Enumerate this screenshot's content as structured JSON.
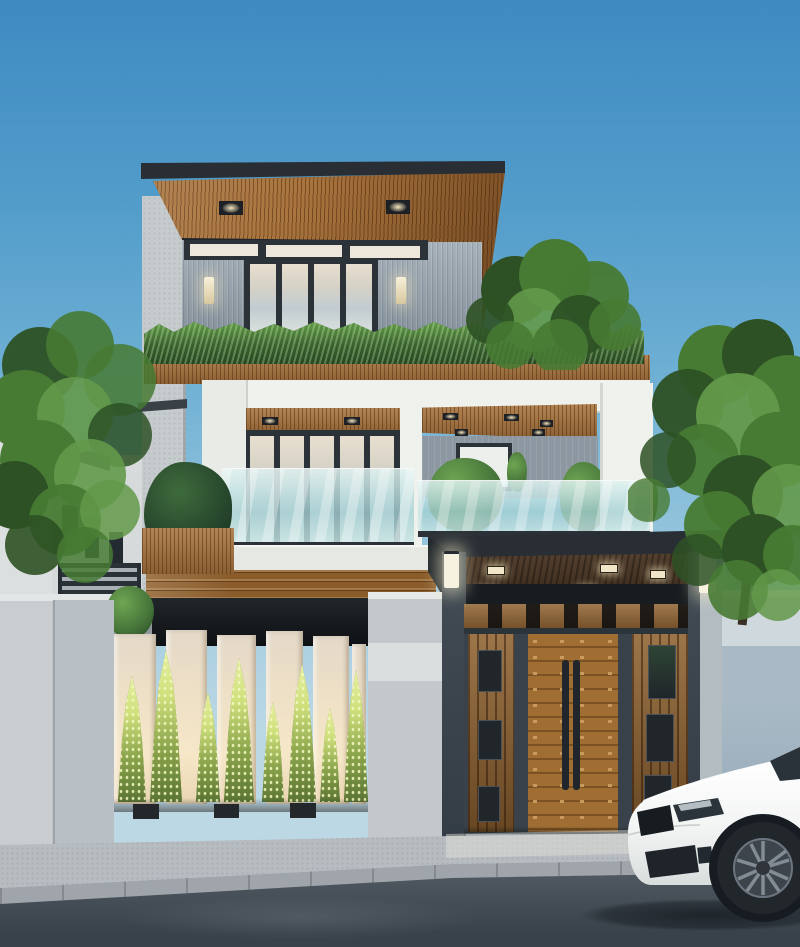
{
  "scene": {
    "type": "photorealistic architectural render",
    "subject": "modern three-story house at dusk with wood-slat roof soffits, glass balconies, backlit slatted fence with conical plants, wooden entry gate and a white sedan parked at the curb",
    "time_of_day": "dusk",
    "objects": [
      "sky",
      "cantilevered roof with wood soffit",
      "recessed ceiling lights",
      "gray vertical siding",
      "transom windows",
      "folding glass doors",
      "wall sconces",
      "balcony hedge",
      "white concrete balcony frame",
      "aqua glass balustrades",
      "terrace window",
      "potted plants",
      "carport canopy",
      "garage opening",
      "slatted fence with backlit cypress plants",
      "wooden double gate with steel frame",
      "gate lamps",
      "concrete boundary walls",
      "neighbor house with dark railing",
      "green trees",
      "sidewalk",
      "curbstones",
      "asphalt road",
      "white sedan with alloy wheel"
    ]
  },
  "palette": {
    "sky_top": "#3e8ac1",
    "sky_mid": "#6fb0d4",
    "sky_low": "#a9cfe0",
    "roof_fascia": "#282e34",
    "wood": "#a9743d",
    "wood_dark": "#7c5226",
    "siding": "#96a3ae",
    "frame_dark": "#2b3238",
    "glass_warm": "#e9dfd0",
    "hedge_light": "#66a14c",
    "hedge_dark": "#274722",
    "box_white": "#eff1ed",
    "concrete": "#c6cbce",
    "garage_dark": "#0e1114",
    "slat_lit": "#f6e7c8",
    "plant_lit": "#cfe07c",
    "plant_dark": "#5a7433",
    "gate_frame": "#39424a",
    "gate_wood": "#8f6230",
    "canopy_soffit": "#4a3523",
    "wall_right": "#92a6b5",
    "wall_left": "#c9cdcf",
    "sidewalk": "#b7bcc0",
    "curb": "#9fa5aa",
    "road": "#49525a",
    "car_white": "#f3f5f4",
    "tree_green": "#477a33",
    "tree_light": "#63994a",
    "tree_dark": "#2d5124",
    "lamp_glow": "#f7f2df"
  }
}
